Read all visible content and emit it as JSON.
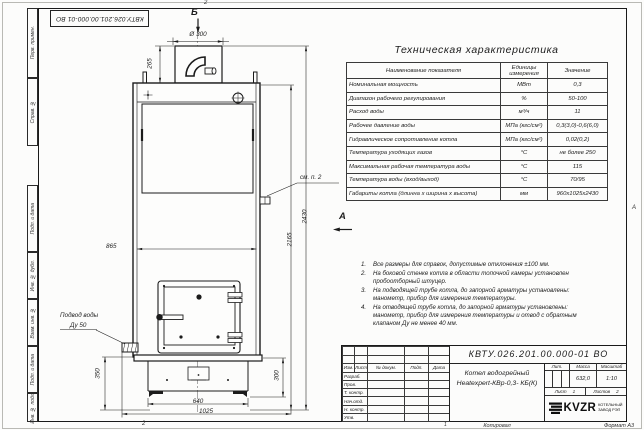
{
  "frame": {
    "left_fields": [
      "Перв. примен.",
      "Справ. №",
      "Подп. и дата",
      "Инв. № дубл.",
      "Взам. инв. №",
      "Подп. и дата",
      "Инв. № подл."
    ],
    "top_stamp": "КВТУ.026.201.00.000-01 ВО",
    "zone_top": "2",
    "zone_bottom": "2",
    "zone_right": "А"
  },
  "drawing": {
    "section_label": "Б",
    "view_label": "А",
    "callout_note2": "см. п. 2",
    "water_supply_line1": "Подвод воды",
    "water_supply_line2": "Ду 50",
    "dims": {
      "chimney_diameter": "Ø 300",
      "chimney_height": "265",
      "body_width": "865",
      "height_body": "2165",
      "height_total": "2430",
      "base_height_left": "350",
      "base_height_right": "300",
      "base_width": "640",
      "overall_width": "1025"
    }
  },
  "spec_table": {
    "title": "Техническая характеристика",
    "headers": [
      "Наименование показателя",
      "Единицы измерения",
      "Значение"
    ],
    "rows": [
      [
        "Номинальная мощность",
        "МВт",
        "0,3"
      ],
      [
        "Диапазон рабочего регулирования",
        "%",
        "50-100"
      ],
      [
        "Расход воды",
        "м³/ч",
        "11"
      ],
      [
        "Рабочее давление воды",
        "МПа (кгс/см²)",
        "0,3(3,0)-0,6(6,0)"
      ],
      [
        "Гидравлическое сопротивление котла",
        "МПа (кгс/см²)",
        "0,02(0,2)"
      ],
      [
        "Температура уходящих газов",
        "°С",
        "не более 250"
      ],
      [
        "Максимальная рабочая температура воды",
        "°С",
        "115"
      ],
      [
        "Температура воды (вход/выход)",
        "°С",
        "70/95"
      ],
      [
        "Габариты котла (длинна х ширина х высота)",
        "мм",
        "960х1025х2430"
      ]
    ]
  },
  "notes": [
    "Все размеры для справок, допустимые отклонения ±100 мм.",
    "На боковой стенке котла в области топочной камеры установлен пробоотборный штуцер.",
    "На подводящей трубе котла, до запорной арматуры установлены: манометр, прибор для измерения температуры.",
    "На отводящей трубе котла, до запорной арматуры установлены: манометр, прибор для измерения температуры и отвод с обратным клапаном Ду не менее 40 мм."
  ],
  "title_block": {
    "doc_number": "КВТУ.026.201.00.000-01 ВО",
    "product_name_line1": "Котел водогрейный",
    "product_name_line2": "Heatexpert-КВр-0,3- КБ(К)",
    "header_cols": [
      "Изм.",
      "Лист",
      "№ докум.",
      "Подп.",
      "Дата"
    ],
    "role_rows": [
      "Разраб.",
      "Пров.",
      "Т. контр.",
      "Нач.отд.",
      "Н. контр.",
      "Утв."
    ],
    "lit_label": "Лит.",
    "mass_label": "Масса",
    "scale_label": "Масштаб",
    "mass_value": "632,0",
    "scale_value": "1:10",
    "sheet_label": "Лист",
    "sheet_value": "1",
    "sheets_label": "Листов",
    "sheets_value": "2",
    "company": "KVZR",
    "company_sub1": "КОТЕЛЬНЫЙ",
    "company_sub2": "ЗАВОД РЭП",
    "copied_label": "Копировал",
    "format_label": "Формат А3",
    "zone1": "1"
  }
}
